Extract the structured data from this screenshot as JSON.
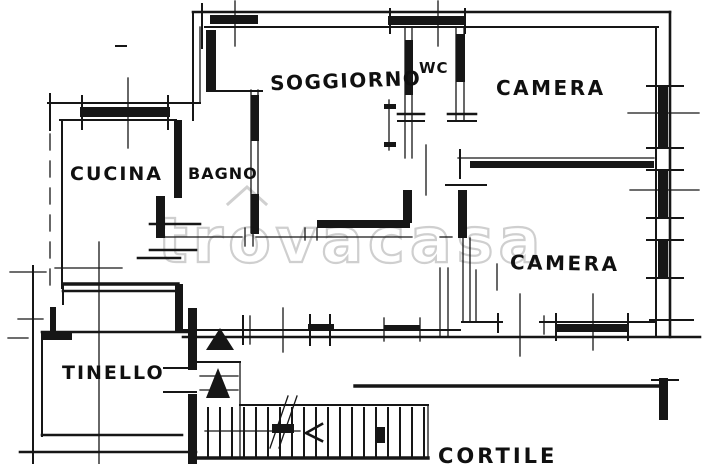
{
  "document": {
    "kind": "scanned hand-drawn apartment floor plan",
    "background": "#ffffff",
    "ink_color": "#161616"
  },
  "watermark": {
    "text": "trovacasa",
    "color": "#cdcdcd"
  },
  "rooms": {
    "soggiorno": {
      "label": "SOGGIORNO"
    },
    "wc": {
      "label": "WC"
    },
    "camera_top": {
      "label": "CAMERA"
    },
    "cucina": {
      "label": "CUCINA"
    },
    "bagno": {
      "label": "BAGNO"
    },
    "camera_bottom": {
      "label": "CAMERA"
    },
    "tinello": {
      "label": "TINELLO"
    },
    "cortile": {
      "label": "CORTILE"
    }
  }
}
